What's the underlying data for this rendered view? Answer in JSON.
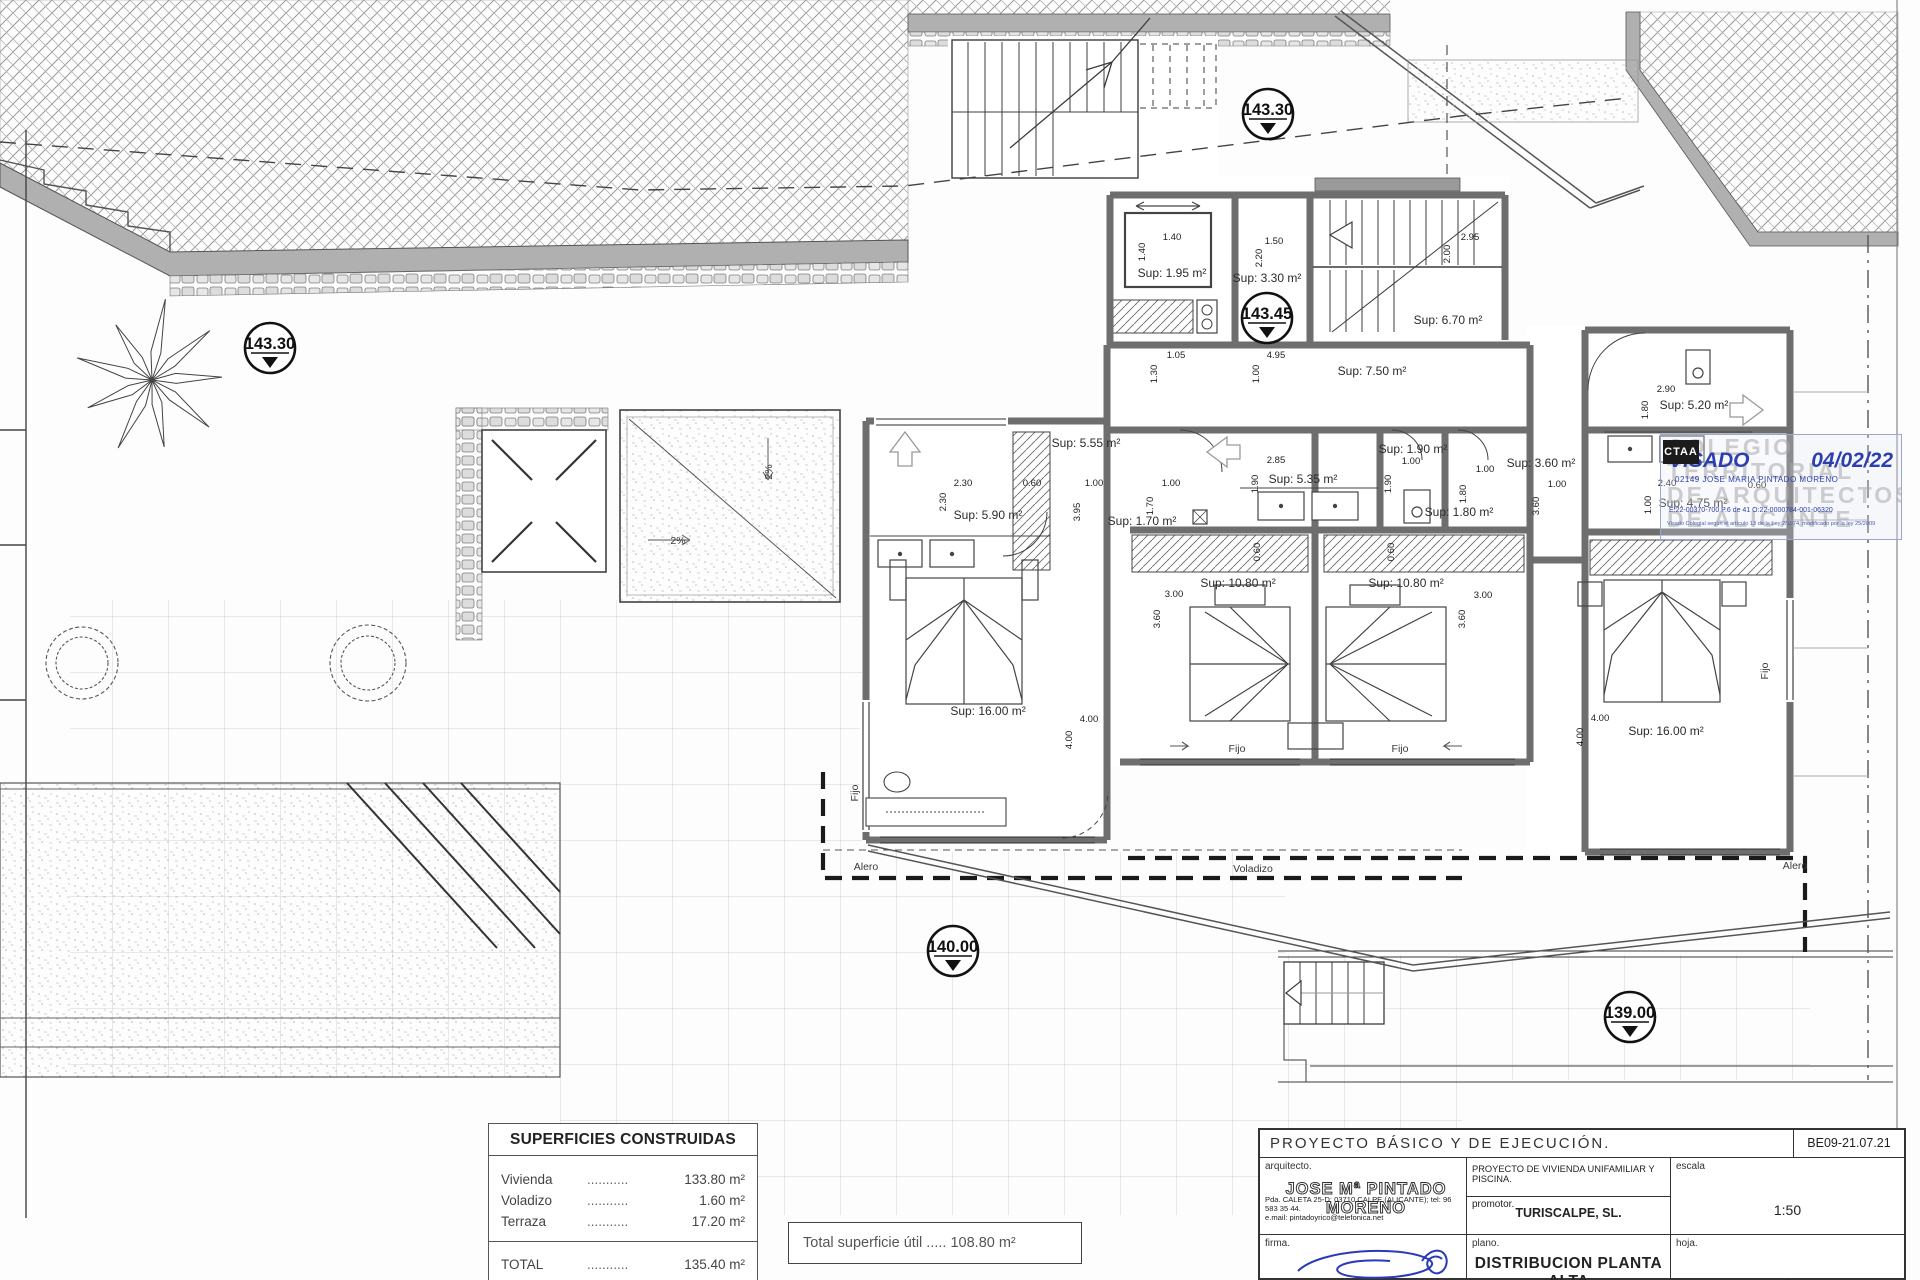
{
  "plan": {
    "area_labels": [
      {
        "t": "Sup: 1.95 m²",
        "x": 1172,
        "y": 277
      },
      {
        "t": "Sup: 3.30 m²",
        "x": 1267,
        "y": 282
      },
      {
        "t": "Sup: 6.70 m²",
        "x": 1448,
        "y": 324
      },
      {
        "t": "Sup: 7.50 m²",
        "x": 1372,
        "y": 375
      },
      {
        "t": "Sup: 5.55 m²",
        "x": 1086,
        "y": 447
      },
      {
        "t": "Sup: 5.90 m²",
        "x": 988,
        "y": 519
      },
      {
        "t": "Sup: 1.70 m²",
        "x": 1142,
        "y": 525
      },
      {
        "t": "Sup: 16.00 m²",
        "x": 988,
        "y": 715
      },
      {
        "t": "Sup: 5.35 m²",
        "x": 1303,
        "y": 483
      },
      {
        "t": "Sup: 1.90 m²",
        "x": 1413,
        "y": 453
      },
      {
        "t": "Sup: 1.80 m²",
        "x": 1459,
        "y": 516
      },
      {
        "t": "Sup: 10.80 m²",
        "x": 1238,
        "y": 587
      },
      {
        "t": "Sup: 10.80 m²",
        "x": 1406,
        "y": 587
      },
      {
        "t": "Sup: 3.60 m²",
        "x": 1541,
        "y": 467
      },
      {
        "t": "Sup: 5.20 m²",
        "x": 1694,
        "y": 409
      },
      {
        "t": "Sup: 4.75 m²",
        "x": 1693,
        "y": 507
      },
      {
        "t": "Sup: 16.00 m²",
        "x": 1666,
        "y": 735
      }
    ],
    "dim_labels": [
      {
        "t": "1.40",
        "x": 1172,
        "y": 240
      },
      {
        "t": "1.40",
        "x": 1145,
        "y": 252,
        "v": true
      },
      {
        "t": "1.50",
        "x": 1274,
        "y": 244
      },
      {
        "t": "2.20",
        "x": 1262,
        "y": 258,
        "v": true
      },
      {
        "t": "2.95",
        "x": 1470,
        "y": 240
      },
      {
        "t": "2.00",
        "x": 1450,
        "y": 254,
        "v": true
      },
      {
        "t": "1.05",
        "x": 1176,
        "y": 358
      },
      {
        "t": "1.30",
        "x": 1157,
        "y": 374,
        "v": true
      },
      {
        "t": "4.95",
        "x": 1276,
        "y": 358
      },
      {
        "t": "1.00",
        "x": 1259,
        "y": 374,
        "v": true
      },
      {
        "t": "2.30",
        "x": 963,
        "y": 486
      },
      {
        "t": "2.30",
        "x": 946,
        "y": 502,
        "v": true
      },
      {
        "t": "0.60",
        "x": 1032,
        "y": 486
      },
      {
        "t": "1.00",
        "x": 1094,
        "y": 486
      },
      {
        "t": "3.95",
        "x": 1080,
        "y": 512,
        "v": true
      },
      {
        "t": "1.00",
        "x": 1171,
        "y": 486
      },
      {
        "t": "1.70",
        "x": 1153,
        "y": 506,
        "v": true
      },
      {
        "t": "2.85",
        "x": 1276,
        "y": 463
      },
      {
        "t": "1.90",
        "x": 1258,
        "y": 484,
        "v": true
      },
      {
        "t": "1.00",
        "x": 1411,
        "y": 464
      },
      {
        "t": "1.90",
        "x": 1391,
        "y": 484,
        "v": true
      },
      {
        "t": "1.00",
        "x": 1485,
        "y": 472
      },
      {
        "t": "1.80",
        "x": 1466,
        "y": 494,
        "v": true
      },
      {
        "t": "0.60",
        "x": 1260,
        "y": 552,
        "v": true
      },
      {
        "t": "0.60",
        "x": 1394,
        "y": 552,
        "v": true
      },
      {
        "t": "3.00",
        "x": 1174,
        "y": 597
      },
      {
        "t": "3.60",
        "x": 1160,
        "y": 619,
        "v": true
      },
      {
        "t": "3.00",
        "x": 1483,
        "y": 598
      },
      {
        "t": "3.60",
        "x": 1465,
        "y": 619,
        "v": true
      },
      {
        "t": "4.00",
        "x": 1089,
        "y": 722
      },
      {
        "t": "4.00",
        "x": 1072,
        "y": 740,
        "v": true
      },
      {
        "t": "4.00",
        "x": 1600,
        "y": 721
      },
      {
        "t": "4.00",
        "x": 1583,
        "y": 737,
        "v": true
      },
      {
        "t": "1.00",
        "x": 1557,
        "y": 487
      },
      {
        "t": "3.60",
        "x": 1539,
        "y": 506,
        "v": true
      },
      {
        "t": "2.40",
        "x": 1667,
        "y": 486
      },
      {
        "t": "1.00",
        "x": 1651,
        "y": 505,
        "v": true
      },
      {
        "t": "0.60",
        "x": 1757,
        "y": 488
      },
      {
        "t": "2.90",
        "x": 1666,
        "y": 392
      },
      {
        "t": "1.80",
        "x": 1648,
        "y": 410,
        "v": true
      }
    ],
    "misc_labels": [
      {
        "t": "Fijo",
        "x": 1237,
        "y": 752
      },
      {
        "t": "Fijo",
        "x": 1400,
        "y": 752
      },
      {
        "t": "Fijo",
        "x": 858,
        "y": 793,
        "v": true
      },
      {
        "t": "Fijo",
        "x": 1768,
        "y": 671,
        "v": true
      },
      {
        "t": "Alero",
        "x": 866,
        "y": 870
      },
      {
        "t": "Voladizo",
        "x": 1253,
        "y": 872
      },
      {
        "t": "Alero",
        "x": 1795,
        "y": 869
      },
      {
        "t": "2%",
        "x": 678,
        "y": 544
      },
      {
        "t": "2%",
        "x": 772,
        "y": 472,
        "v": true
      }
    ],
    "level_markers": [
      {
        "v": "143.30",
        "x": 1268,
        "y": 114
      },
      {
        "v": "143.30",
        "x": 270,
        "y": 348
      },
      {
        "v": "143.45",
        "x": 1267,
        "y": 318
      },
      {
        "v": "140.00",
        "x": 953,
        "y": 951
      },
      {
        "v": "139.00",
        "x": 1630,
        "y": 1017
      }
    ]
  },
  "surfaces_table": {
    "title": "SUPERFICIES CONSTRUIDAS",
    "rows": [
      {
        "name": "Vivienda",
        "dots": "...........",
        "value": "133.80 m²"
      },
      {
        "name": "Voladizo",
        "dots": "...........",
        "value": "1.60 m²"
      },
      {
        "name": "Terraza",
        "dots": "...........",
        "value": "17.20 m²"
      }
    ],
    "total": {
      "name": "TOTAL",
      "dots": "...........",
      "value": "135.40 m²"
    }
  },
  "total_usable": {
    "text": "Total superficie útil ..... 108.80 m²"
  },
  "stamp": {
    "logo": "CTAA",
    "watermark_lines": [
      "COLEGIO",
      "TERRITORIAL",
      "DE ARQUITECTOS",
      "DE ALICANTE"
    ],
    "visado": "VISADO",
    "date": "04/02/22",
    "holder": "02149 JOSE MARIA PINTADO MORENO",
    "codes": "E:22-00370-700      P.6 de 41      O:22-0000784-001-06320",
    "legal": "Visado Colegial según el artículo 13 de la Ley 2/1974, modificado por la ley 25/2009"
  },
  "title_block": {
    "project_type": "PROYECTO  BÁSICO  Y  DE  EJECUCIÓN.",
    "code": "BE09-21.07.21",
    "arquitecto_label": "arquitecto.",
    "architect": "JOSE Mª PINTADO MORENO",
    "address": "Pda. CALETA 25-D; 03710 CALPE (ALICANTE); tel: 96 583 35 44.",
    "email": "e.mail:  pintadoyrico@telefonica.net",
    "project_desc": "PROYECTO DE VIVIENDA UNIFAMILIAR Y PISCINA.",
    "promotor_label": "promotor.",
    "promotor": "TURISCALPE, SL.",
    "escala_label": "escala",
    "escala": "1:50",
    "firma_label": "firma.",
    "plano_label": "plano.",
    "plano": "DISTRIBUCION  PLANTA  ALTA",
    "hoja_label": "hoja.",
    "hoja": "9"
  }
}
